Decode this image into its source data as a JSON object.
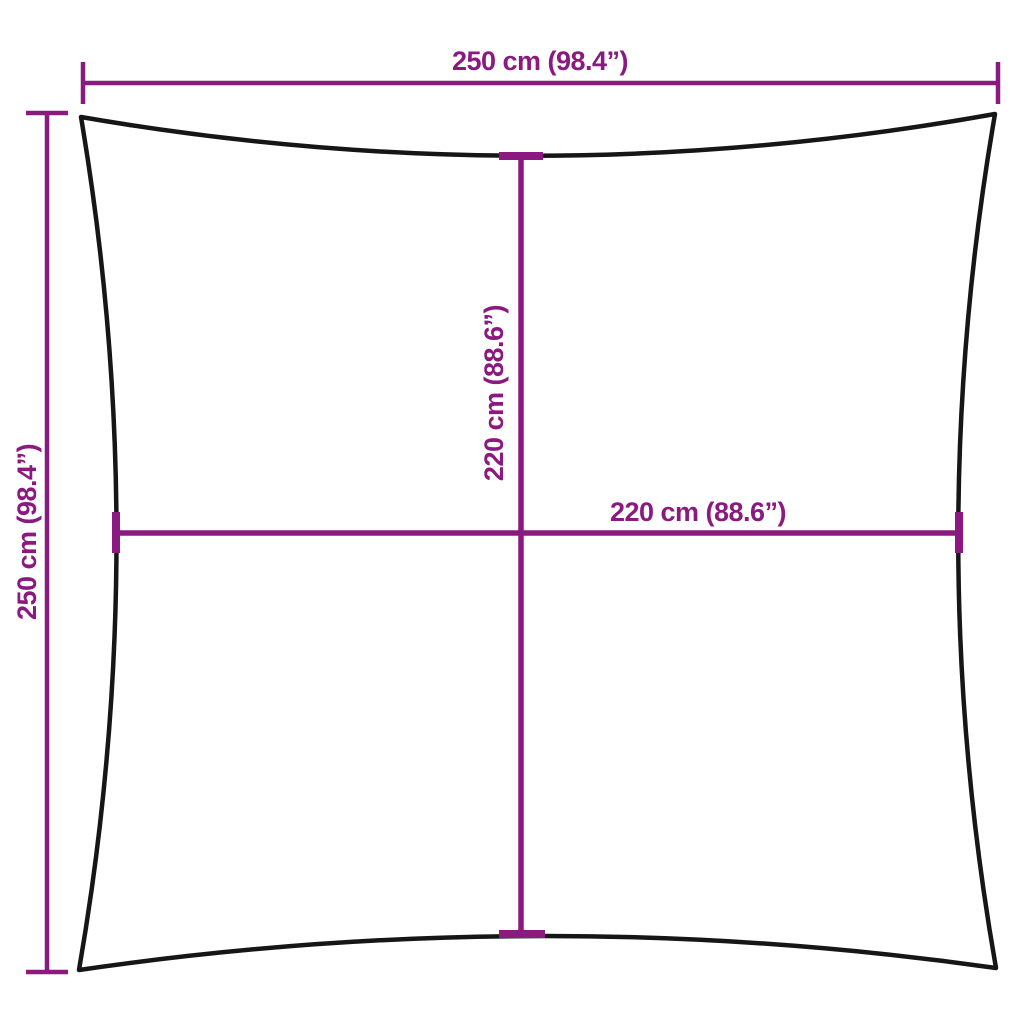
{
  "diagram": {
    "title": "square shade sail dimension diagram",
    "labels": {
      "top_width": "250 cm (98.4”)",
      "left_height": "250 cm (98.4”)",
      "inner_height": "220 cm (88.6”)",
      "inner_width": "220 cm (88.6”)"
    },
    "colors": {
      "outline": "#161616",
      "dimension": "#8B1A80",
      "background": "#ffffff"
    }
  }
}
